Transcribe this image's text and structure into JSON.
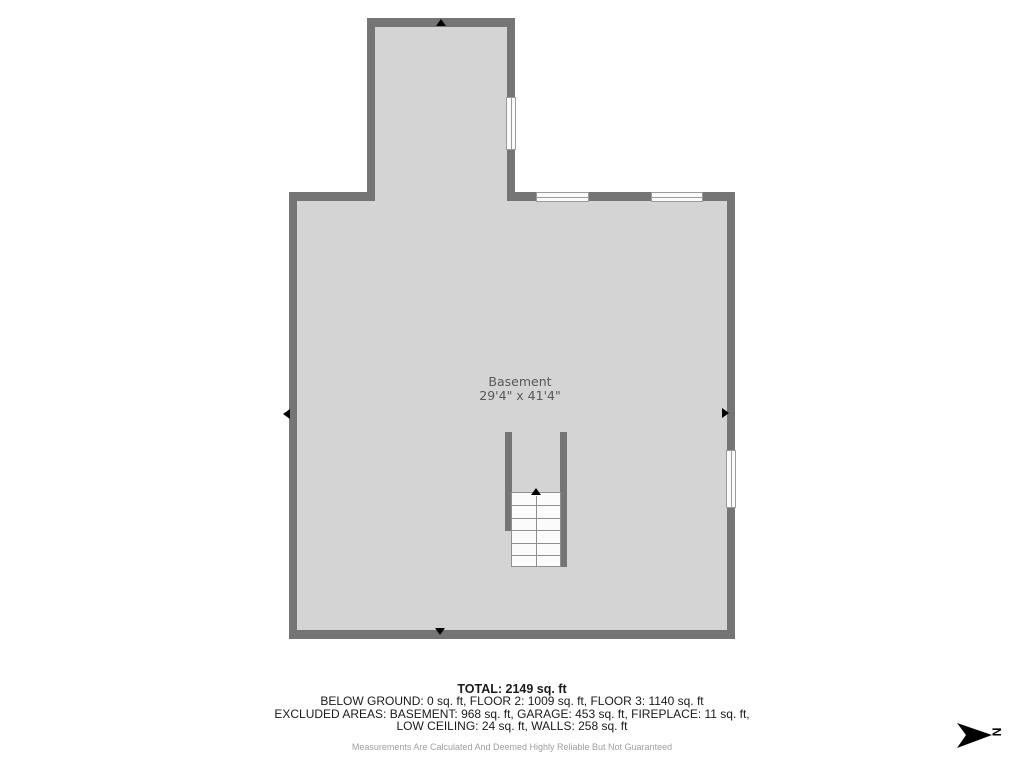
{
  "colors": {
    "wall": "#757575",
    "floor": "#d4d4d4",
    "window_fill": "#fbfbfb",
    "window_frame": "#9b9b9b",
    "stair_line": "#8f8f8f",
    "label_text": "#595959",
    "summary_text": "#1a1a1a",
    "disclaimer_text": "#9e9e9e",
    "compass": "#000000"
  },
  "floor_plan": {
    "room": {
      "name": "Basement",
      "dimensions": "29'4\" x 41'4\""
    }
  },
  "summary": {
    "total": "TOTAL: 2149 sq. ft",
    "floors": "BELOW GROUND: 0 sq. ft, FLOOR 2: 1009 sq. ft, FLOOR 3: 1140 sq. ft",
    "excluded_line1": "EXCLUDED AREAS: BASEMENT: 968 sq. ft, GARAGE: 453 sq. ft, FIREPLACE: 11 sq. ft,",
    "excluded_line2": "LOW CEILING: 24 sq. ft, WALLS: 258 sq. ft",
    "disclaimer": "Measurements Are Calculated And Deemed Highly Reliable But Not Guaranteed"
  },
  "compass": {
    "north_label": "N"
  }
}
